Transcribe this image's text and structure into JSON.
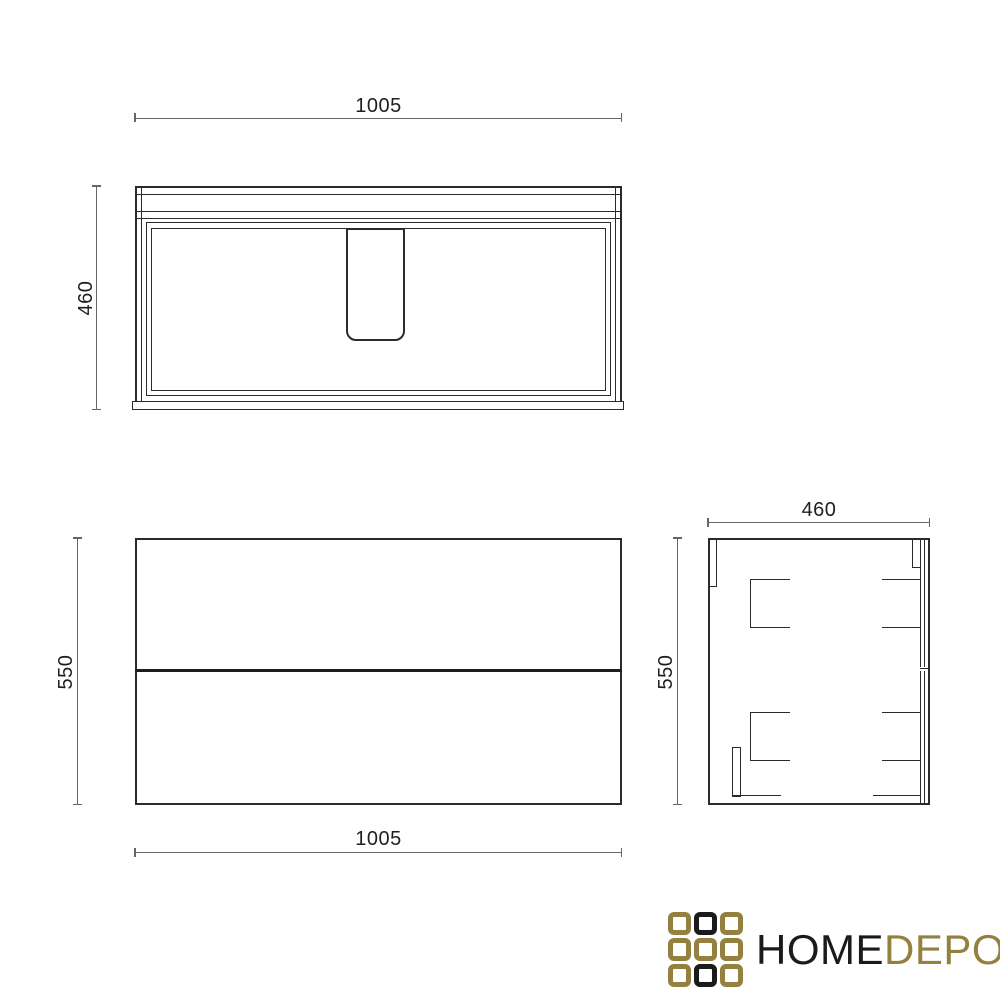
{
  "background": "#ffffff",
  "colors": {
    "drawing_line": "#2b2b2b",
    "dimension_line": "#666666",
    "dimension_text": "#1f1f1f"
  },
  "drawing": {
    "type": "furniture-technical-drawing",
    "subject": "wall-hung vanity cabinet with basin, two drawers",
    "dimensions_mm": {
      "width": 1005,
      "depth": 460,
      "height": 550
    }
  },
  "views": {
    "top": {
      "title": "top-view",
      "width_label": "1005",
      "depth_label": "460"
    },
    "front": {
      "title": "front-view",
      "width_label": "1005",
      "height_label": "550"
    },
    "side": {
      "title": "side-view",
      "depth_label": "460",
      "height_label": "550"
    }
  },
  "logo": {
    "text_primary": "HOME",
    "text_secondary": "DEPO",
    "colors": {
      "gold": "#94803f",
      "dark": "#1b1b1b"
    },
    "grid": [
      "gold",
      "dark",
      "gold",
      "gold",
      "gold",
      "gold",
      "gold",
      "dark",
      "gold"
    ]
  }
}
